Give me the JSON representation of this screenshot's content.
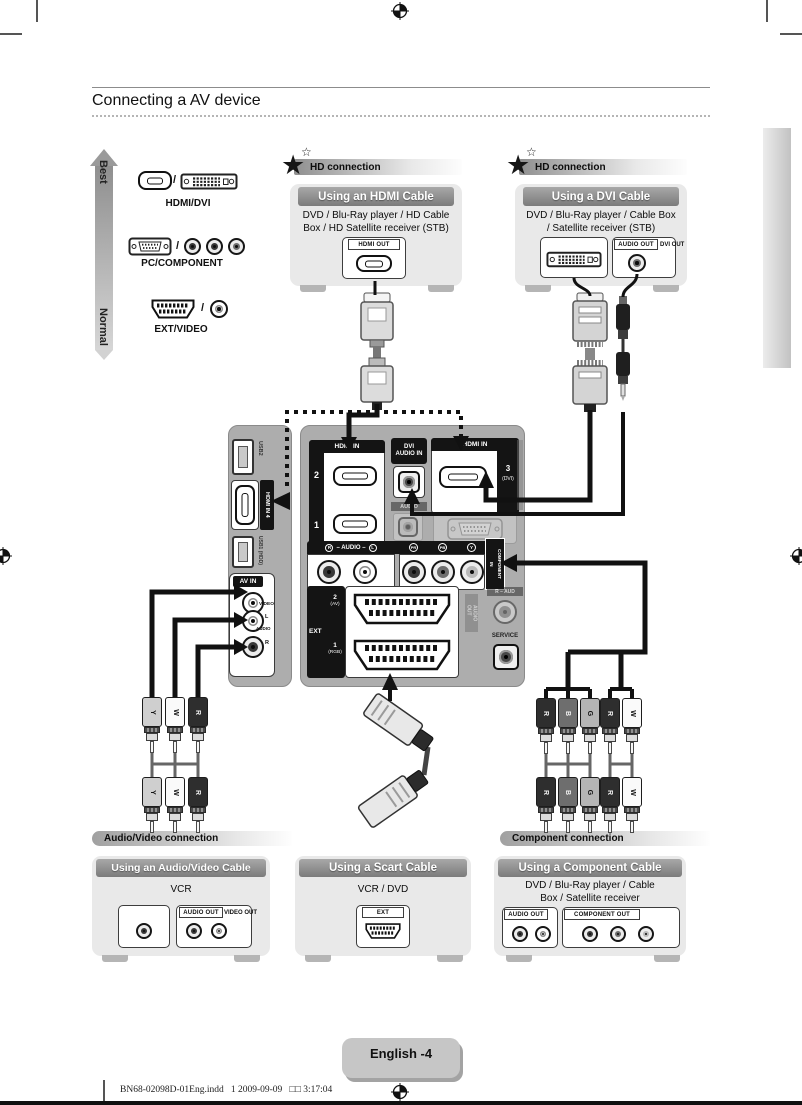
{
  "icons": {
    "star": "★",
    "star_small": "☆",
    "slash": "/"
  },
  "header": {
    "title": "Connecting a AV device"
  },
  "quality_scale": {
    "best": "Best",
    "normal": "Normal"
  },
  "legend": {
    "items": [
      {
        "label": "HDMI/DVI"
      },
      {
        "label": "PC/COMPONENT"
      },
      {
        "label": "EXT/VIDEO"
      }
    ]
  },
  "hd_badge": {
    "label": "HD connection"
  },
  "hdmi_card": {
    "title": "Using an HDMI Cable",
    "devices": "DVD / Blu-Ray player / HD Cable\nBox / HD Satellite receiver (STB)",
    "port_label": "HDMI OUT"
  },
  "dvi_card": {
    "title": "Using a DVI Cable",
    "devices": "DVD / Blu-Ray player / Cable Box\n/ Satellite receiver (STB)",
    "audio_label": "AUDIO OUT",
    "dvi_label": "DVI OUT"
  },
  "side_panel": {
    "usb2": "USB2",
    "hdmi4": "HDMI IN 4",
    "usb1": "USB1 (HDD)",
    "av_in": "AV IN",
    "video": "VIDEO",
    "audio": "AUDIO",
    "left": "L",
    "right": "R"
  },
  "back_panel": {
    "hdmi_header": "HDMI IN",
    "port_2": "2",
    "port_1": "1",
    "dvi_audio_in": "DVI\nAUDIO IN",
    "hdmi3_header": "HDMI IN",
    "port_3": "3",
    "port_3_sub": "(DVI)",
    "audio_label": "AUDIO",
    "audio_lr": "– AUDIO –",
    "r": "R",
    "l": "L",
    "pr": "PR",
    "pb": "PB",
    "y": "Y",
    "component_in": "COMPONENT\nIN",
    "ext": "EXT",
    "ext2": "2",
    "ext2_sub": "(AV)",
    "ext1": "1",
    "ext1_sub": "(RGB)",
    "audio_out": "AUDIO\nOUT",
    "r_aud": "R – AUD",
    "service": "SERVICE"
  },
  "sections": {
    "av": "Audio/Video connection",
    "component": "Component connection"
  },
  "av_card": {
    "title": "Using an Audio/Video Cable",
    "devices": "VCR",
    "audio_label": "AUDIO OUT",
    "video_label": "VIDEO OUT"
  },
  "scart_card": {
    "title": "Using a Scart Cable",
    "devices": "VCR / DVD",
    "port_label": "EXT"
  },
  "component_card": {
    "title": "Using a Component Cable",
    "devices": "DVD / Blu-Ray player / Cable\nBox / Satellite receiver",
    "audio_label": "AUDIO OUT",
    "component_label": "COMPONENT OUT"
  },
  "cables": {
    "av_labels": [
      "Y",
      "W",
      "R"
    ],
    "component_labels": [
      "R",
      "B",
      "G"
    ],
    "component_audio_labels": [
      "R",
      "W"
    ]
  },
  "footer": {
    "page_badge": "English -4",
    "print_line": "BN68-02098D-01Eng.indd   1 2009-09-09   □□ 3:17:04"
  },
  "colors": {
    "panel_gray": "#adadad",
    "card_bg": "#e9e9e9",
    "title_bar_dark": "#7b7b7b",
    "black": "#111111",
    "faded_gray": "#9a9a9a"
  }
}
